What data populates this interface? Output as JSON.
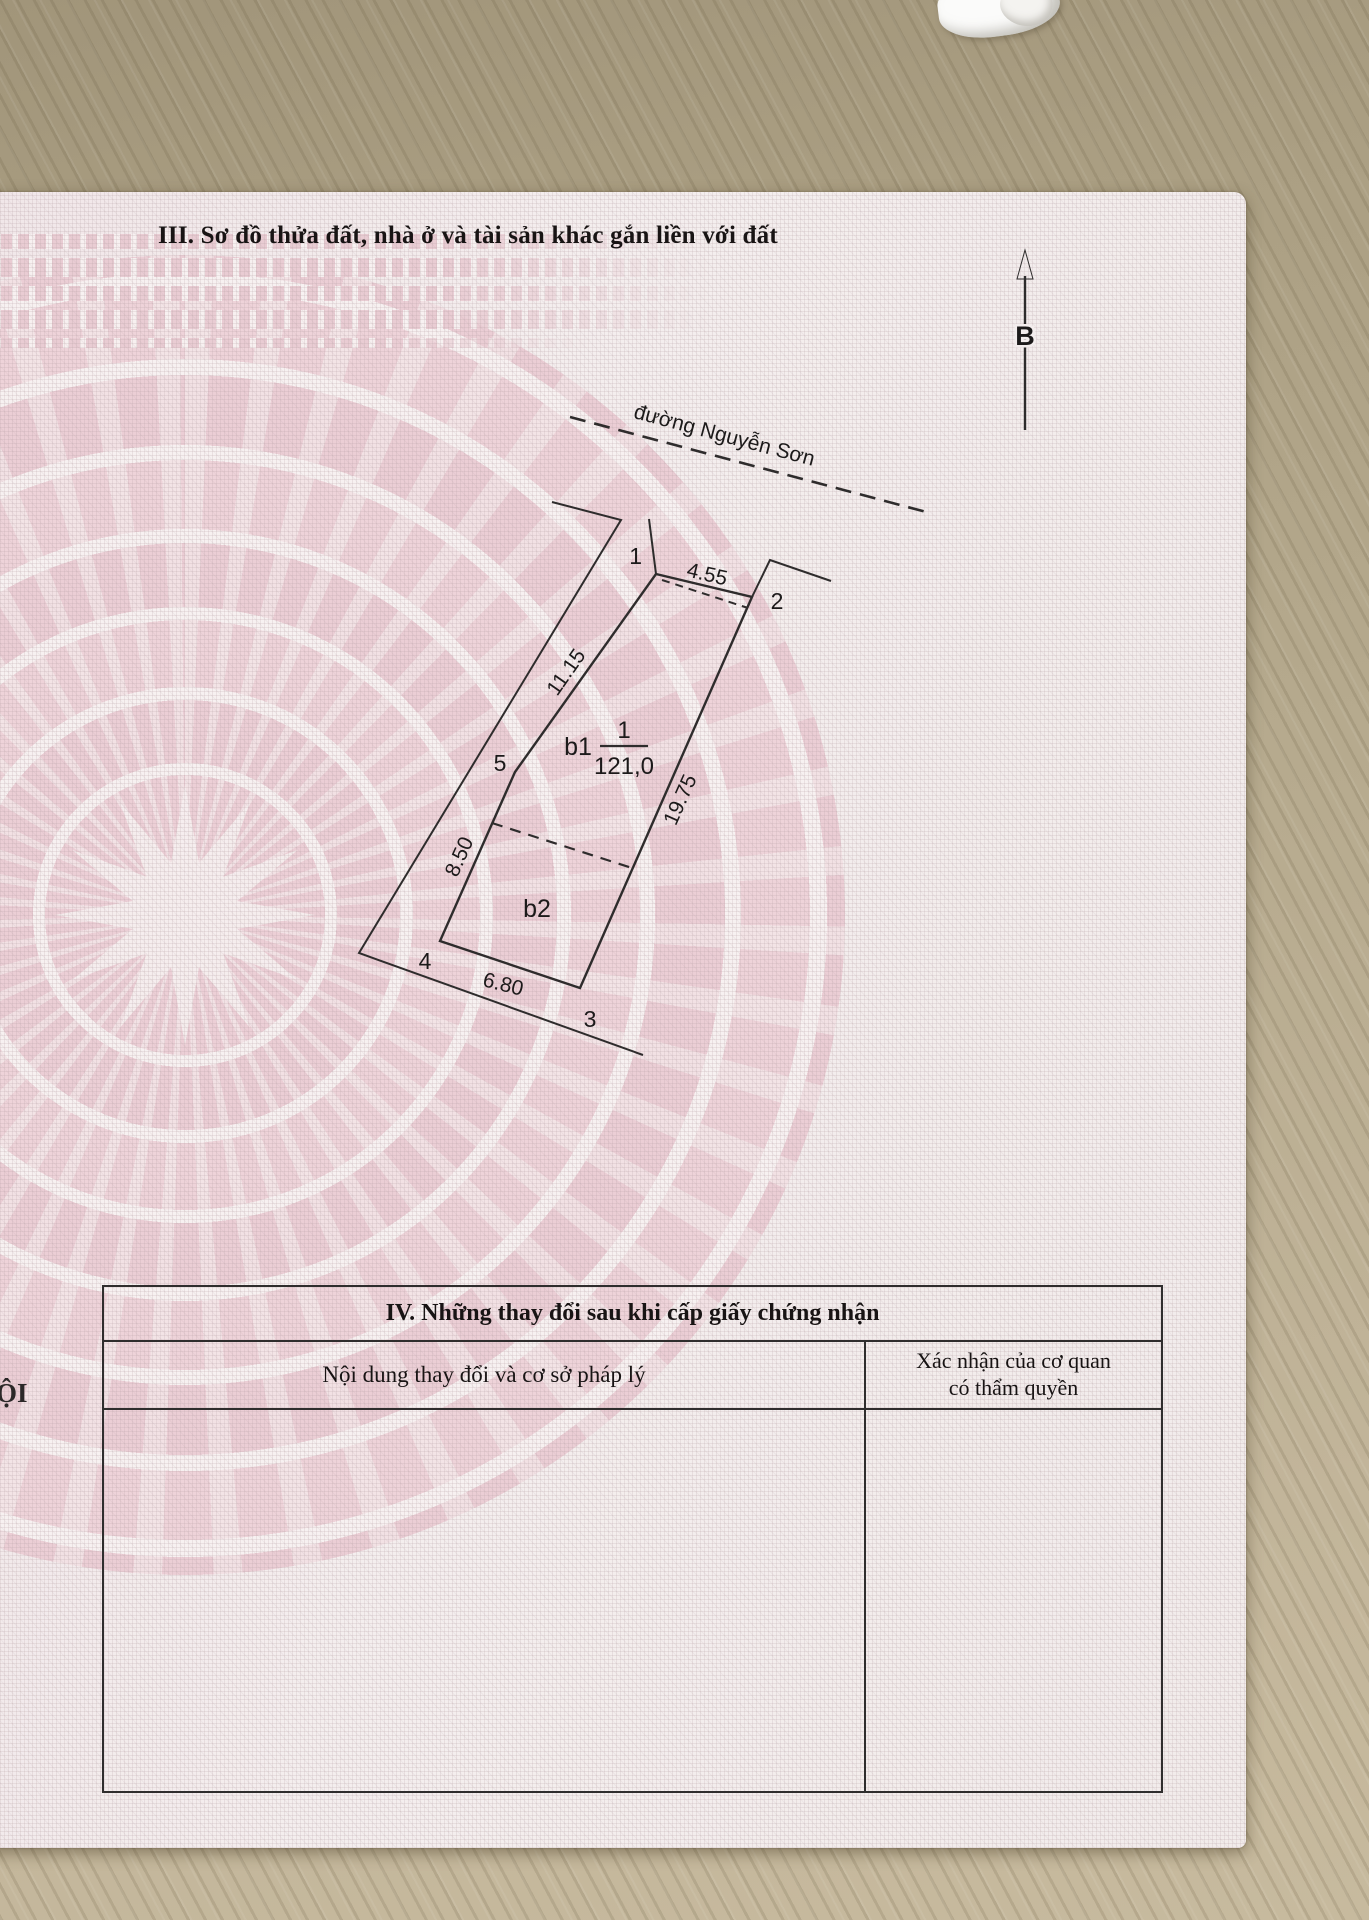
{
  "doc": {
    "margin_text": "ỘI",
    "section3": {
      "title": "III. Sơ đồ thửa đất, nhà ở và tài sản khác gắn liền với đất",
      "diagram": {
        "north_label": "B",
        "street_label": "đường Nguyễn Sơn",
        "parcel_number": "1",
        "parcel_area": "121,0",
        "vertices": [
          "1",
          "2",
          "3",
          "4",
          "5"
        ],
        "edge_lengths": {
          "v1_v2": "4.55",
          "v2_v3": "19.75",
          "v3_v4": "6.80",
          "v4_v5": "8.50",
          "v5_v1": "11.15"
        },
        "subarea_b1": "b1",
        "subarea_b2": "b2"
      }
    },
    "section4": {
      "title": "IV. Những thay đổi sau khi cấp giấy chứng nhận",
      "col1_header": "Nội dung thay đổi và cơ sở pháp lý",
      "col2_header_line1": "Xác nhận của cơ quan",
      "col2_header_line2": "có thẩm quyền"
    },
    "colors": {
      "paper_pink": "#eccfd6",
      "paper_base": "#f3eded",
      "ink": "#2e2c2c",
      "wood": "#b6aa8e"
    }
  }
}
